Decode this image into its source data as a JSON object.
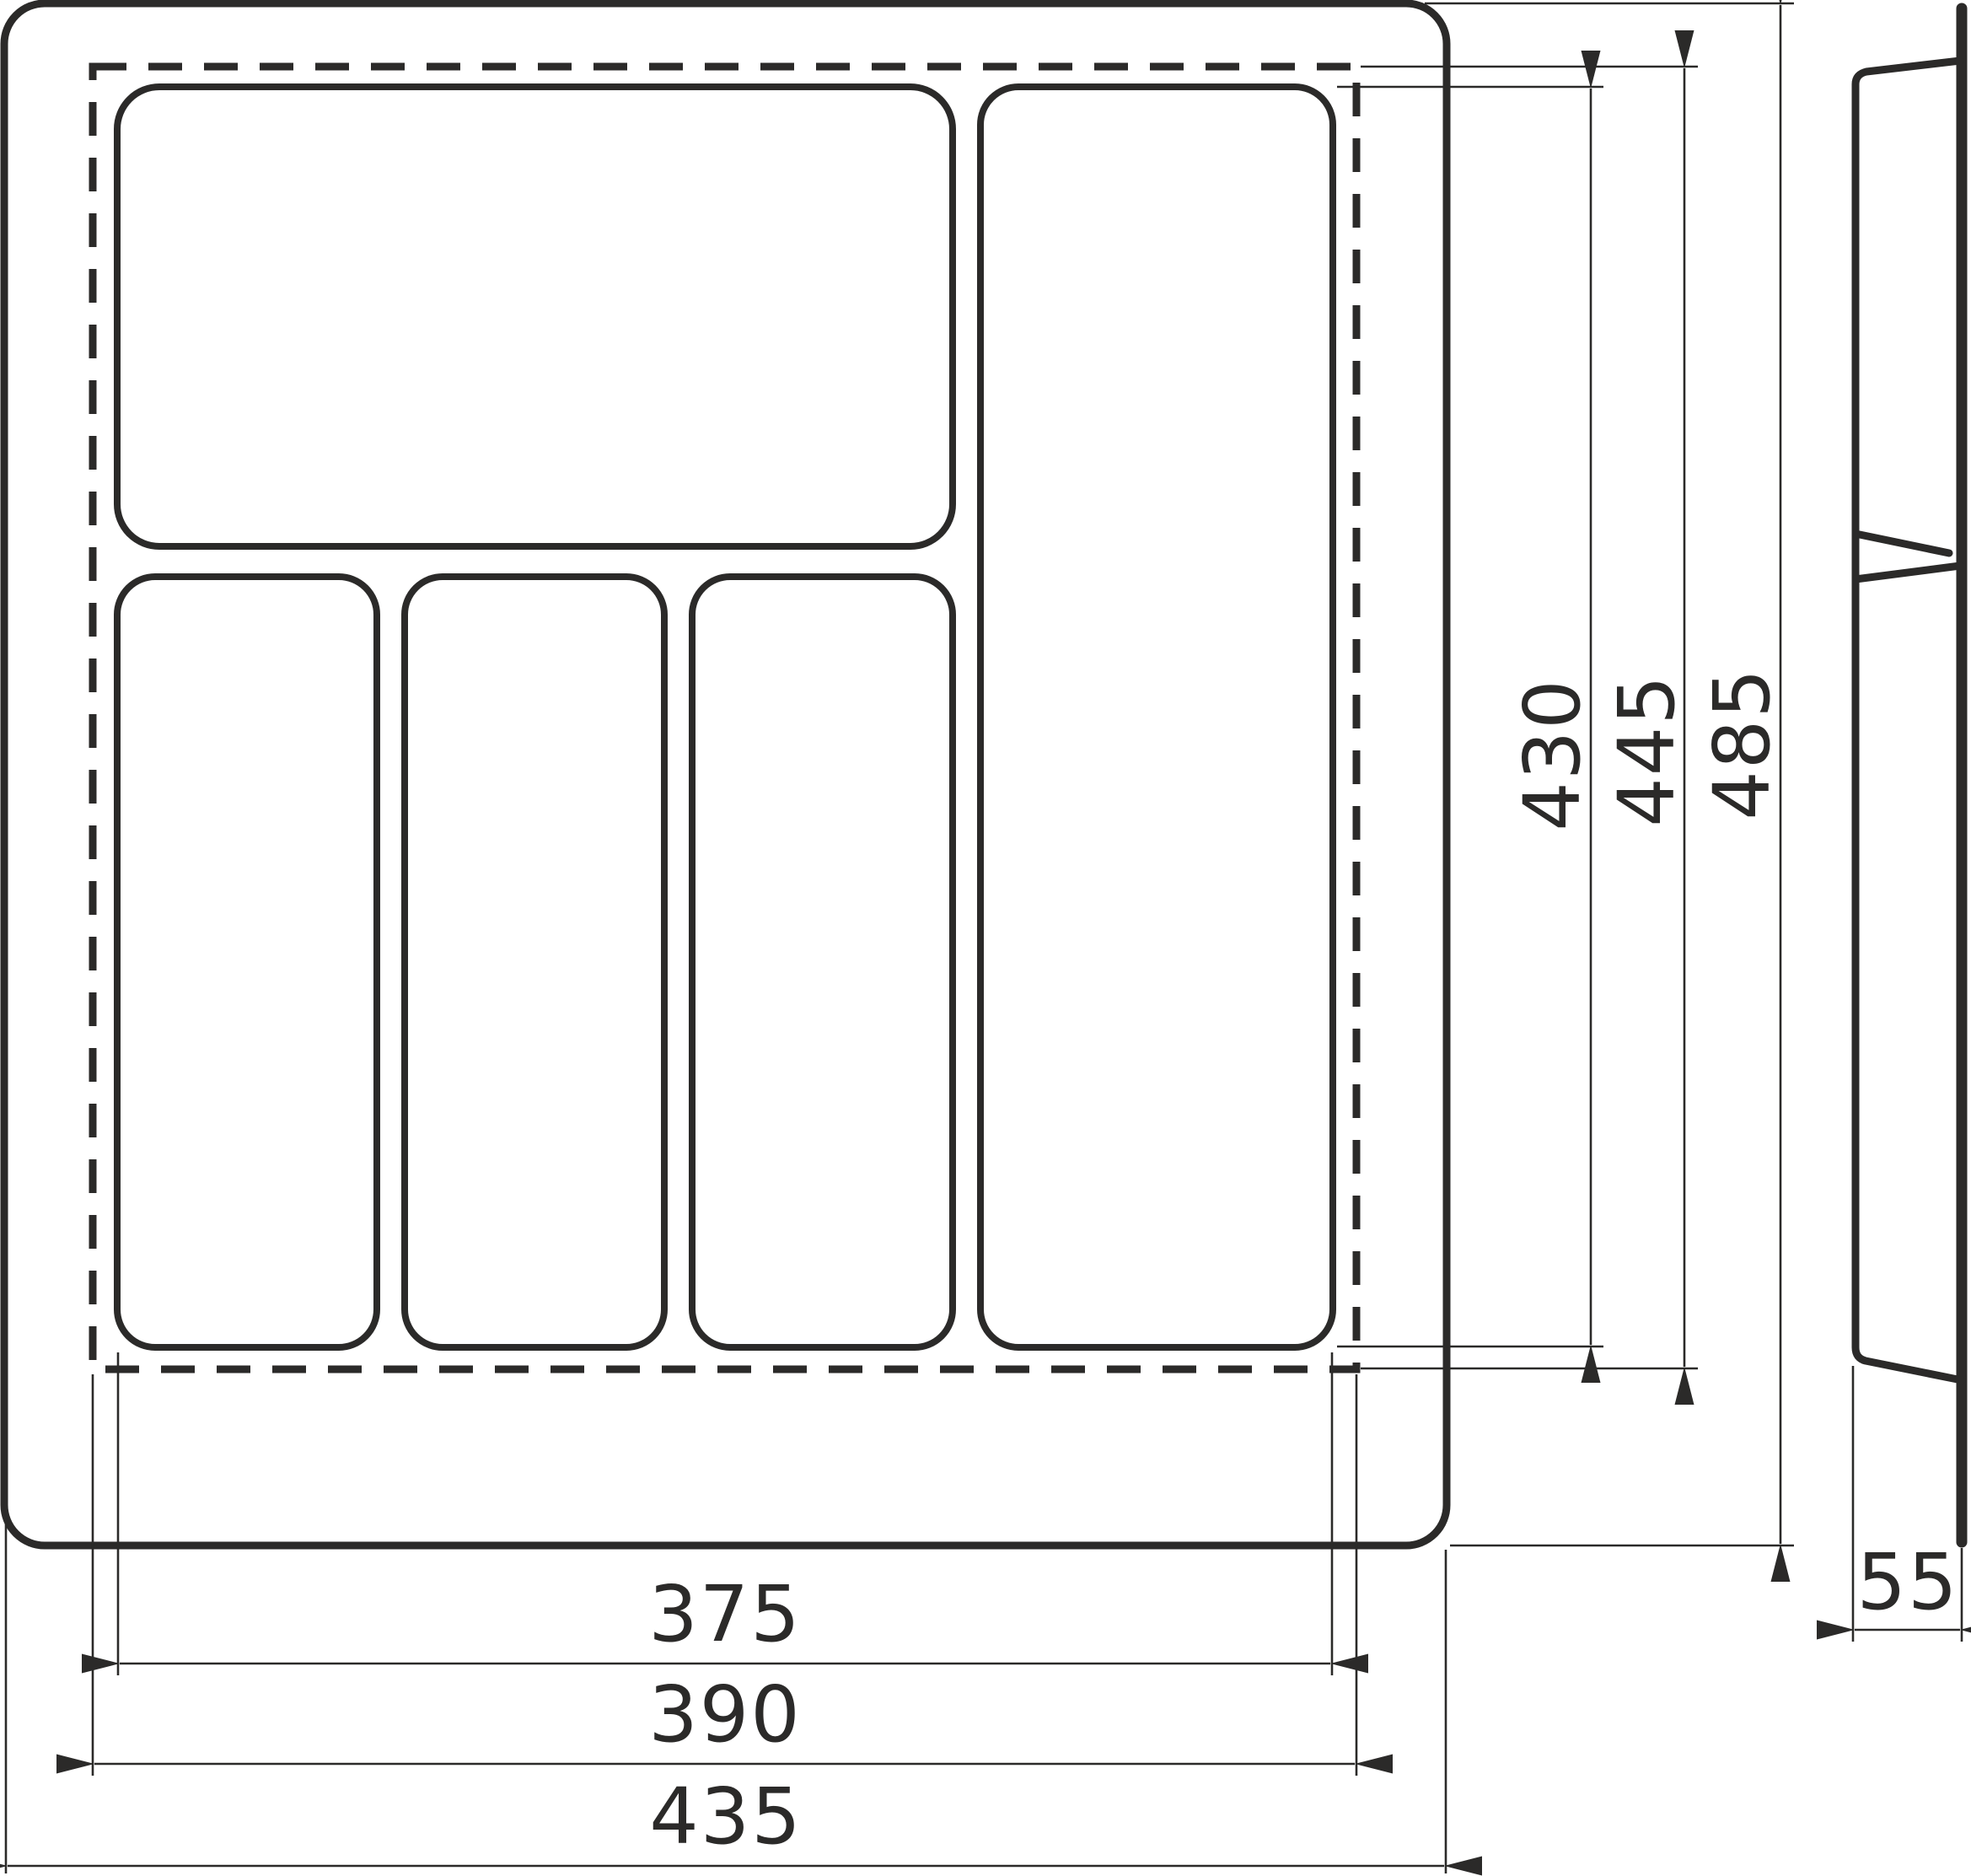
{
  "drawing": {
    "description": "cutlery-tray-technical-drawing",
    "line_color": "#2b2a29",
    "background_color": "#ffffff",
    "views": {
      "top_view_name": "tray-top-view",
      "side_view_name": "tray-side-profile"
    },
    "dimensions": {
      "inner_width": {
        "label": "375"
      },
      "cut_width": {
        "label": "390"
      },
      "full_width": {
        "label": "435"
      },
      "inner_height": {
        "label": "430"
      },
      "cut_height": {
        "label": "445"
      },
      "full_height": {
        "label": "485"
      },
      "side_thickness": {
        "label": "55"
      }
    }
  }
}
